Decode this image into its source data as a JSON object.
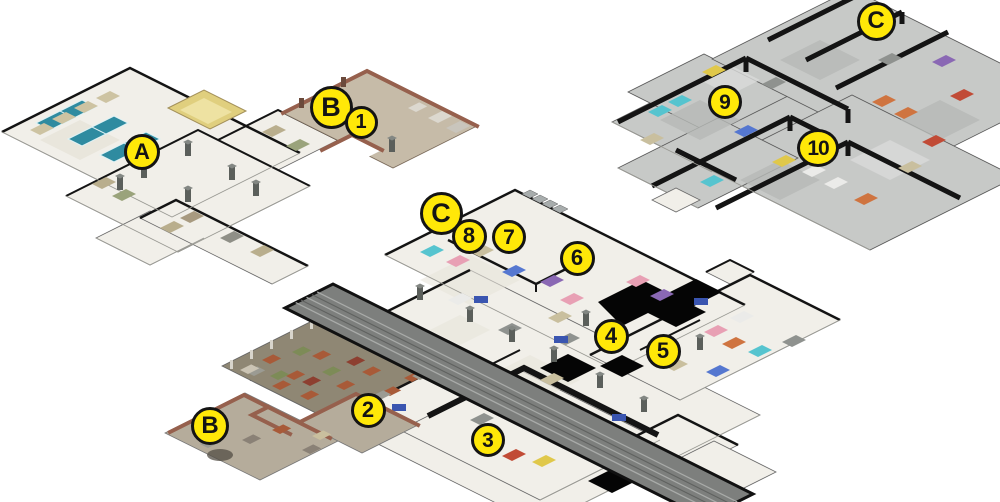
{
  "map": {
    "colors": {
      "background": "#ffffff",
      "marker_fill": "#ffe808",
      "marker_border": "#141414",
      "marker_text": "#141414",
      "wall_dark": "#141414",
      "wall_brick": "#96604d",
      "floor_light": "#f1efe9",
      "floor_gray": "#c7c9c7",
      "floor_tan": "#c6bba8",
      "floor_dirt": "#8f8774",
      "floor_yard": "#b5ac9b",
      "roof_walkway": "#7d7f7d",
      "pool_table": "#2f8ba0"
    },
    "markers": [
      {
        "id": "A",
        "label": "A",
        "x": 142,
        "y": 152,
        "w": 36,
        "h": 36
      },
      {
        "id": "B1",
        "label": "B",
        "x": 331,
        "y": 107,
        "w": 43,
        "h": 43
      },
      {
        "id": "1",
        "label": "1",
        "x": 361,
        "y": 122,
        "w": 33,
        "h": 33
      },
      {
        "id": "C1",
        "label": "C",
        "x": 876,
        "y": 21,
        "w": 39,
        "h": 39
      },
      {
        "id": "9",
        "label": "9",
        "x": 725,
        "y": 102,
        "w": 34,
        "h": 34
      },
      {
        "id": "10",
        "label": "10",
        "x": 818,
        "y": 148,
        "w": 42,
        "h": 38
      },
      {
        "id": "C2",
        "label": "C",
        "x": 441,
        "y": 213,
        "w": 43,
        "h": 43
      },
      {
        "id": "8",
        "label": "8",
        "x": 469,
        "y": 236,
        "w": 35,
        "h": 35
      },
      {
        "id": "7",
        "label": "7",
        "x": 509,
        "y": 237,
        "w": 34,
        "h": 34
      },
      {
        "id": "6",
        "label": "6",
        "x": 577,
        "y": 258,
        "w": 35,
        "h": 35
      },
      {
        "id": "4",
        "label": "4",
        "x": 611,
        "y": 336,
        "w": 35,
        "h": 35
      },
      {
        "id": "5",
        "label": "5",
        "x": 663,
        "y": 351,
        "w": 35,
        "h": 35
      },
      {
        "id": "2",
        "label": "2",
        "x": 368,
        "y": 410,
        "w": 35,
        "h": 35
      },
      {
        "id": "3",
        "label": "3",
        "x": 488,
        "y": 440,
        "w": 34,
        "h": 34
      },
      {
        "id": "B2",
        "label": "B",
        "x": 210,
        "y": 426,
        "w": 38,
        "h": 38
      }
    ]
  }
}
